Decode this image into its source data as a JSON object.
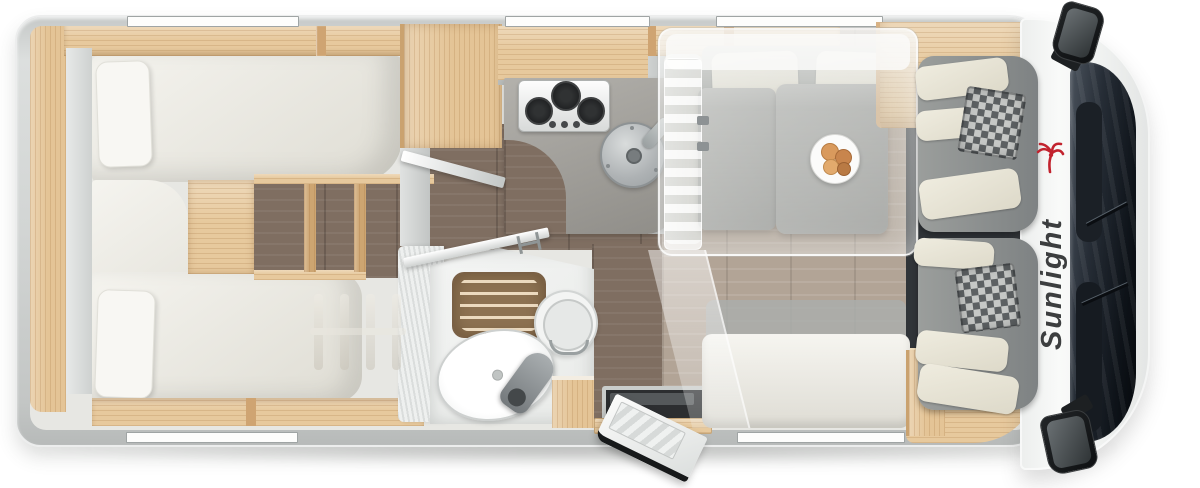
{
  "page": {
    "background_color": "#ffffff",
    "subject": "Motorhome floor plan, top-down 3D render, rear on left and cab on right"
  },
  "brand": {
    "logo_text": "Sunlight",
    "logo_text_color": "#3c3e3f",
    "logo_palm_color": "#c2232e"
  },
  "zones": {
    "rear_bedroom": [
      "single-bed-top",
      "single-bed-bottom",
      "pillows",
      "steps-between-beds",
      "wardrobe-with-open-mirror-door",
      "overhead-lockers",
      "ghost-ladder-on-bed"
    ],
    "kitchen": [
      "three-burner-gas-hob",
      "round-sink-with-faucet",
      "l-shaped-counter",
      "overhead-locker"
    ],
    "bathroom": [
      "shower-with-wood-grate",
      "toilet",
      "washbasin",
      "gray-faucet",
      "wood-cabinet",
      "open-bathroom-door"
    ],
    "dinette": [
      "dinette-table",
      "plate-with-bread-rolls",
      "bench-seat-left",
      "bench-seat-top",
      "side-bench-bottom",
      "drop-down-bed-translucent-overlay"
    ],
    "cab": [
      "driver-seat-swiveled",
      "passenger-seat-swiveled",
      "checkered-headrests",
      "windshield",
      "dashboard",
      "side-mirror-top",
      "side-mirror-bottom"
    ],
    "entrance": [
      "open-entry-door",
      "entry-step-well",
      "wood-threshold"
    ]
  },
  "windows": {
    "top_wall_count": 3,
    "bottom_wall_count": 2
  },
  "colors": {
    "outer_wall": "#d2d5d4",
    "wood_light_oak": "#e7c99d",
    "floor_dark_plank": "#7f6e61",
    "floor_dinette_plank": "#b2a496",
    "mattress": "#f0eee7",
    "kitchen_counter": "#9b9994",
    "table_top": "#a7a8a5",
    "windshield": "#12161d",
    "seat_base_gray": "#85888a",
    "seat_cushion_cream": "#ece9dc",
    "shower_grate_wood": "#8d7252",
    "step_well": "#2c2e30"
  }
}
